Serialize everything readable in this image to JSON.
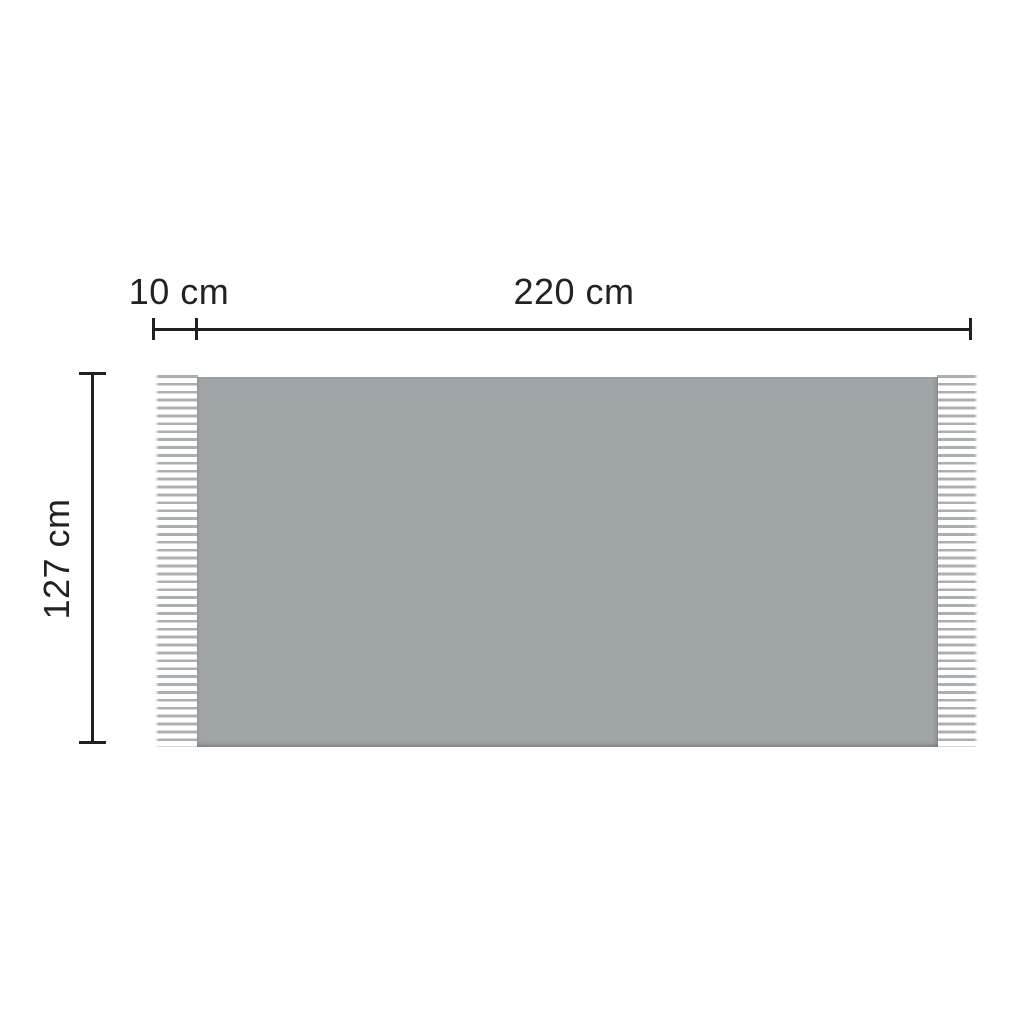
{
  "diagram": {
    "labels": {
      "fringe_width": "10 cm",
      "body_width": "220 cm",
      "height": "127 cm"
    }
  },
  "colors": {
    "background": "#ffffff",
    "blanket_body": "#a0a5a8",
    "fringe": "#abafb2",
    "dimension_line": "#202020",
    "label_text": "#222222"
  }
}
